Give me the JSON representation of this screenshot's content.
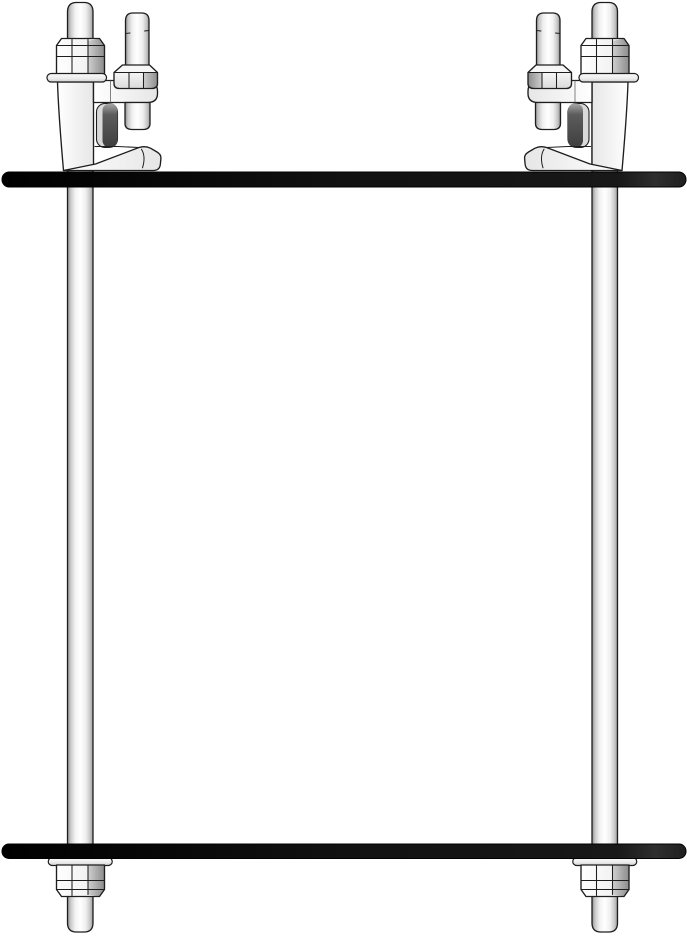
{
  "diagram": {
    "subject": "Beam clamp trapeze hanger assembly technical drawing",
    "colors": {
      "background": "#ffffff",
      "outline": "#1e1e1e",
      "bar": "#111111",
      "bar_end": "#2e2e2e",
      "metal_highlight": "#ffffff",
      "metal_mid": "#e9e9e9",
      "metal_shadow": "#8e8e8e",
      "clamp_slot_shadow": "#3f3f3f"
    },
    "parts": [
      {
        "id": "top-flange-bar",
        "label": "top flange bar"
      },
      {
        "id": "left-beam-clamp",
        "label": "left beam clamp with set screw"
      },
      {
        "id": "right-beam-clamp",
        "label": "right beam clamp with set screw"
      },
      {
        "id": "left-threaded-rod",
        "label": "left threaded rod with hex nuts and washers"
      },
      {
        "id": "right-threaded-rod",
        "label": "right threaded rod with hex nuts and washers"
      },
      {
        "id": "bottom-support-bar",
        "label": "bottom support bar"
      }
    ]
  }
}
